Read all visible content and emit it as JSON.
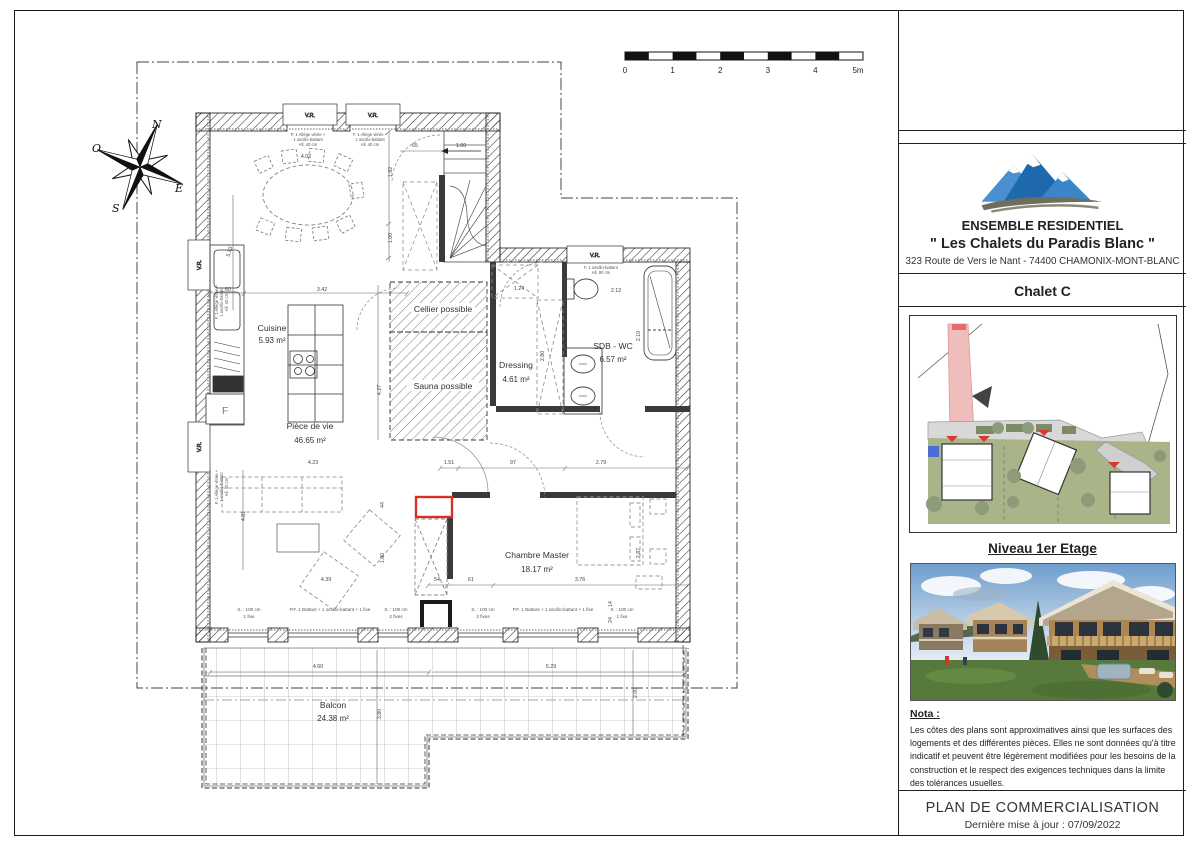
{
  "title_block": {
    "company_line1": "ENSEMBLE RESIDENTIEL",
    "company_line2": "\" Les Chalets du Paradis Blanc \"",
    "address": "323 Route de Vers le Nant - 74400 CHAMONIX-MONT-BLANC",
    "unit": "Chalet C",
    "level_title": "Niveau 1er Etage",
    "nota_title": "Nota :",
    "nota_text": "Les côtes des plans sont approximatives ainsi que les surfaces des logements et des différentes pièces. Elles ne sont données qu'à titre indicatif et peuvent être légèrement modifiées pour les besoins de la construction et le respect des exigences techniques dans la limite des tolérances usuelles.",
    "footer_title": "PLAN DE COMMERCIALISATION",
    "footer_sub": "Dernière mise à jour : 07/09/2022"
  },
  "compass": {
    "n": "N",
    "s": "S",
    "e": "E",
    "o": "O"
  },
  "scale_bar": {
    "labels": [
      "0",
      "1",
      "2",
      "3",
      "4",
      "5m"
    ]
  },
  "colors": {
    "accent_red": "#d93025",
    "logo_blue_dark": "#1e69ab",
    "logo_blue_light": "#4a90d0",
    "road_pink": "#f0bdbd",
    "lawn_green": "#aab489"
  },
  "plan": {
    "rooms": [
      {
        "name": "Cuisine",
        "area": "5.93 m²"
      },
      {
        "name": "Pièce de vie",
        "area": "46.65 m²"
      },
      {
        "name": "Cellier possible",
        "area": ""
      },
      {
        "name": "Sauna possible",
        "area": ""
      },
      {
        "name": "Dressing",
        "area": "4.61 m²"
      },
      {
        "name": "SDB - WC",
        "area": "6.57 m²"
      },
      {
        "name": "Chambre Master",
        "area": "18.17 m²"
      },
      {
        "name": "Balcon",
        "area": "24.38 m²"
      }
    ],
    "fridge_tag": "F",
    "window_tags": [
      "V.R.",
      "V.R.",
      "V.R.",
      "V.R.",
      "V.R."
    ],
    "window_notes": [
      {
        "lines": [
          "P. 1 Allège vitrée +",
          "1 oscillo-battant",
          "All. 40 cm"
        ],
        "x": 308,
        "y": 136
      },
      {
        "lines": [
          "F. 1 Allège vitrée +",
          "1 oscillo-battant",
          "All. 40 cm"
        ],
        "x": 370,
        "y": 136
      },
      {
        "lines": [
          "F. 1 Allège vitrée +",
          "1 oscillo-battant",
          "All. 40 cm"
        ],
        "x": 218,
        "y": 302,
        "r": -90
      },
      {
        "lines": [
          "F. 1 Allège vitrée +",
          "1 oscillo-battant",
          "All. 40 cm"
        ],
        "x": 218,
        "y": 487,
        "r": -90
      },
      {
        "lines": [
          "F. 1 oscillo-battant",
          "All. 90 cm"
        ],
        "x": 601,
        "y": 269
      }
    ],
    "openings": [
      {
        "lines": [
          "S. : 100 cm",
          "1 fixe"
        ],
        "x": 249
      },
      {
        "lines": [
          "P.F. 1 Battant + 1 oscillo-battant + 1 fixe"
        ],
        "x": 330
      },
      {
        "lines": [
          "S. : 100 cm",
          "2 fixes"
        ],
        "x": 396
      },
      {
        "lines": [
          "S. : 100 cm",
          "2 fixes"
        ],
        "x": 483
      },
      {
        "lines": [
          "P.F. 1 Battant + 1 oscillo-battant + 1 fixe"
        ],
        "x": 553
      },
      {
        "lines": [
          "S. : 100 cm",
          "1 fixe"
        ],
        "x": 622
      }
    ],
    "dimensions": [
      {
        "t": "60",
        "x": 228,
        "y": 291
      },
      {
        "t": "3.42",
        "x": 322,
        "y": 291
      },
      {
        "t": "4.02",
        "x": 306,
        "y": 158
      },
      {
        "t": "65",
        "x": 415,
        "y": 147
      },
      {
        "t": "1.00",
        "x": 461,
        "y": 147
      },
      {
        "t": "1.92",
        "x": 392,
        "y": 172,
        "r": -90
      },
      {
        "t": "1.00",
        "x": 392,
        "y": 238,
        "r": -90
      },
      {
        "t": "5.13",
        "x": 231,
        "y": 252,
        "r": -75
      },
      {
        "t": "4.27",
        "x": 381,
        "y": 390,
        "r": -90
      },
      {
        "t": "1.24",
        "x": 519,
        "y": 290
      },
      {
        "t": "2.12",
        "x": 616,
        "y": 292
      },
      {
        "t": "2.80",
        "x": 544,
        "y": 356,
        "r": -90
      },
      {
        "t": "2.10",
        "x": 640,
        "y": 336,
        "r": -90
      },
      {
        "t": "1.51",
        "x": 449,
        "y": 464
      },
      {
        "t": "97",
        "x": 513,
        "y": 464
      },
      {
        "t": "2.79",
        "x": 601,
        "y": 464
      },
      {
        "t": "4.23",
        "x": 313,
        "y": 464
      },
      {
        "t": "4.81",
        "x": 245,
        "y": 516,
        "r": -90
      },
      {
        "t": "44",
        "x": 384,
        "y": 505,
        "r": -90
      },
      {
        "t": "1.80",
        "x": 384,
        "y": 558,
        "r": -90
      },
      {
        "t": "2.87",
        "x": 640,
        "y": 553,
        "r": -90
      },
      {
        "t": "4.39",
        "x": 326,
        "y": 581
      },
      {
        "t": "54",
        "x": 437,
        "y": 581
      },
      {
        "t": "61",
        "x": 471,
        "y": 581
      },
      {
        "t": "3.76",
        "x": 580,
        "y": 581
      },
      {
        "t": "14",
        "x": 612,
        "y": 604,
        "r": -90
      },
      {
        "t": "24",
        "x": 612,
        "y": 620,
        "r": -90
      },
      {
        "t": "4.60",
        "x": 318,
        "y": 668
      },
      {
        "t": "5.29",
        "x": 551,
        "y": 668
      },
      {
        "t": "3.80",
        "x": 381,
        "y": 714,
        "r": -90
      },
      {
        "t": "2.00",
        "x": 637,
        "y": 693,
        "r": -90
      }
    ]
  }
}
